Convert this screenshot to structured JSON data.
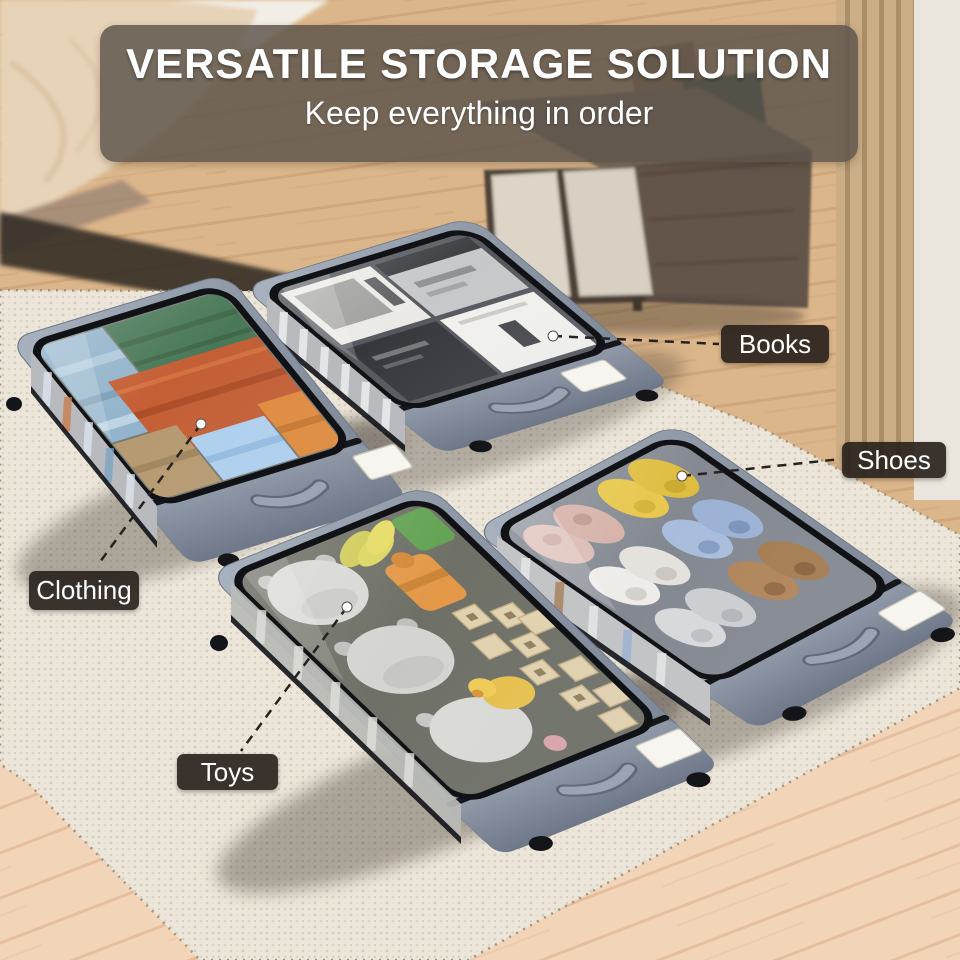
{
  "banner": {
    "title": "VERSATILE STORAGE SOLUTION",
    "subtitle": "Keep everything in order"
  },
  "callouts": [
    {
      "id": "books",
      "label": "Books"
    },
    {
      "id": "shoes",
      "label": "Shoes"
    },
    {
      "id": "clothing",
      "label": "Clothing"
    },
    {
      "id": "toys",
      "label": "Toys"
    }
  ],
  "colors": {
    "banner_bg": "rgba(92,83,75,0.82)",
    "callout_bg": "rgba(42,35,29,0.92)",
    "text": "#ffffff",
    "bin_fabric": "#8b95a3",
    "bin_trim": "#111317",
    "rug": "#ece6da",
    "wood_floor": "#dab488",
    "connector_line": "#26221e"
  }
}
